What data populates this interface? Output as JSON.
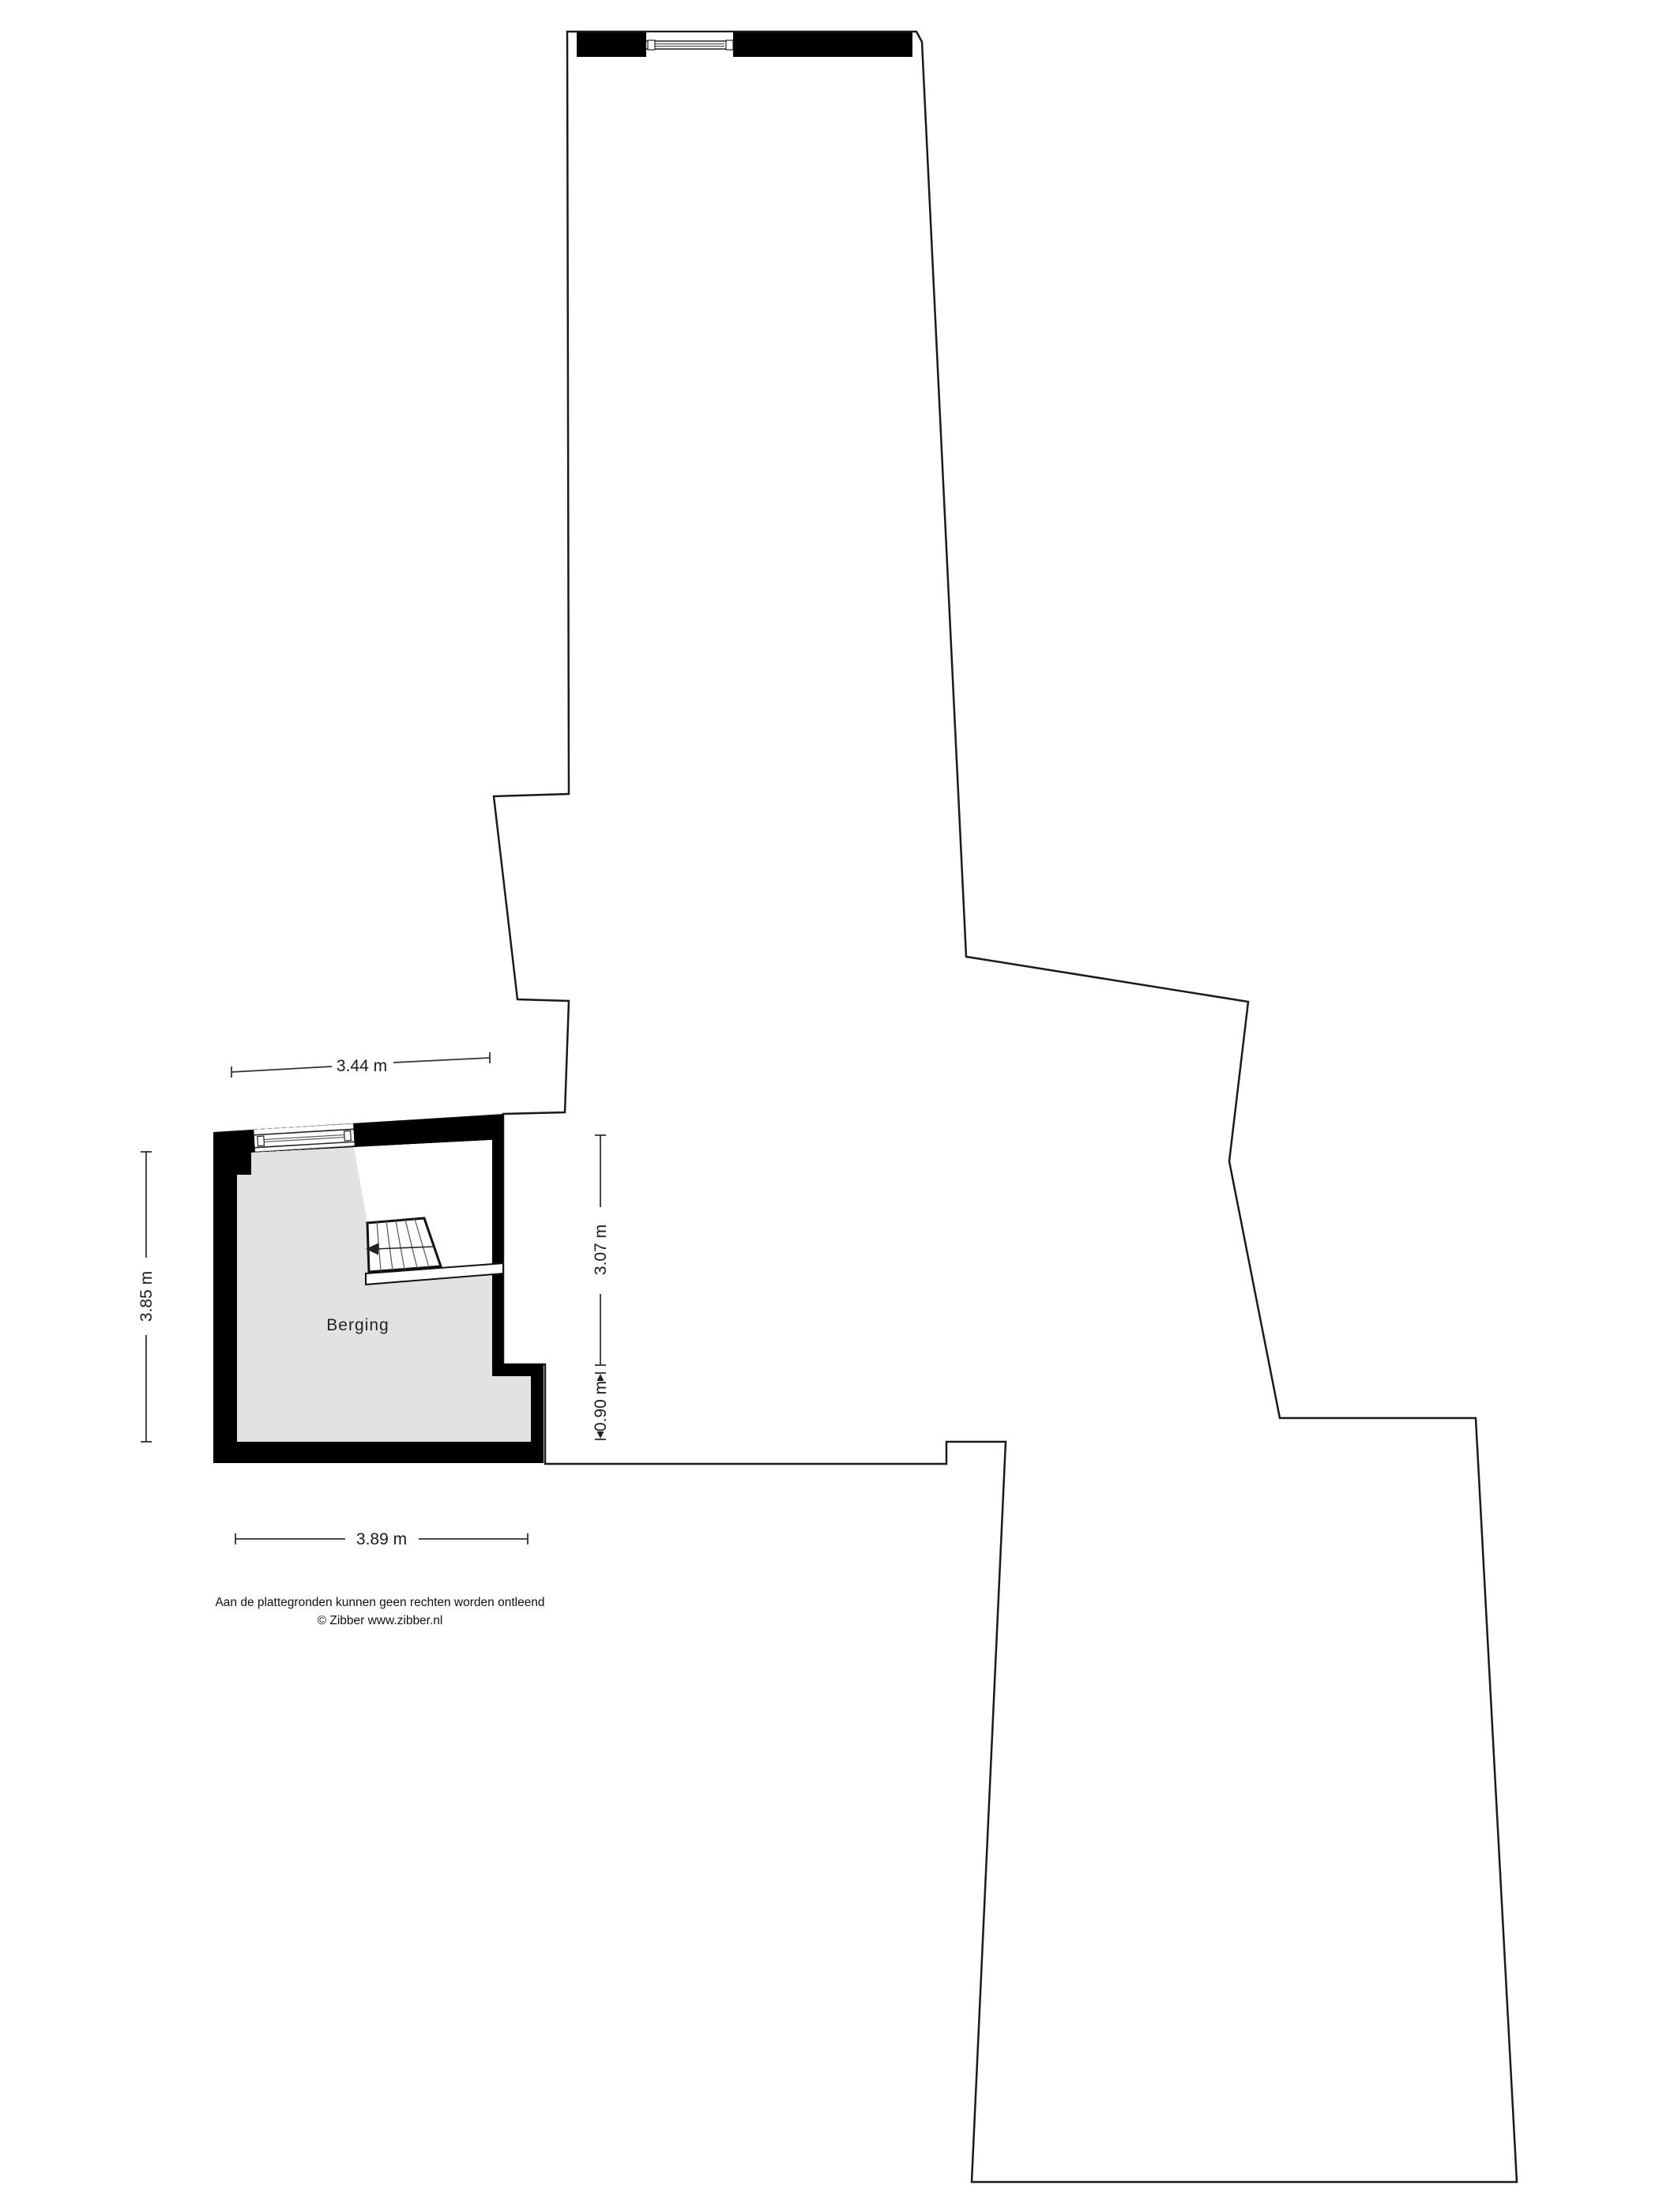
{
  "floorplan": {
    "room": {
      "label": "Berging"
    },
    "dimensions": {
      "top_width": "3.44 m",
      "left_height": "3.85 m",
      "right_height_upper": "3.07 m",
      "right_height_lower": "0.90 m",
      "bottom_width": "3.89 m"
    },
    "footer": {
      "disclaimer": "Aan de plattegronden kunnen geen rechten worden ontleend",
      "copyright": "© Zibber www.zibber.nl"
    },
    "colors": {
      "wall": "#000000",
      "floor": "#e2e2e2",
      "outline_stroke": "#1a1a1a",
      "text": "#1a1a1a",
      "background": "#ffffff"
    }
  }
}
